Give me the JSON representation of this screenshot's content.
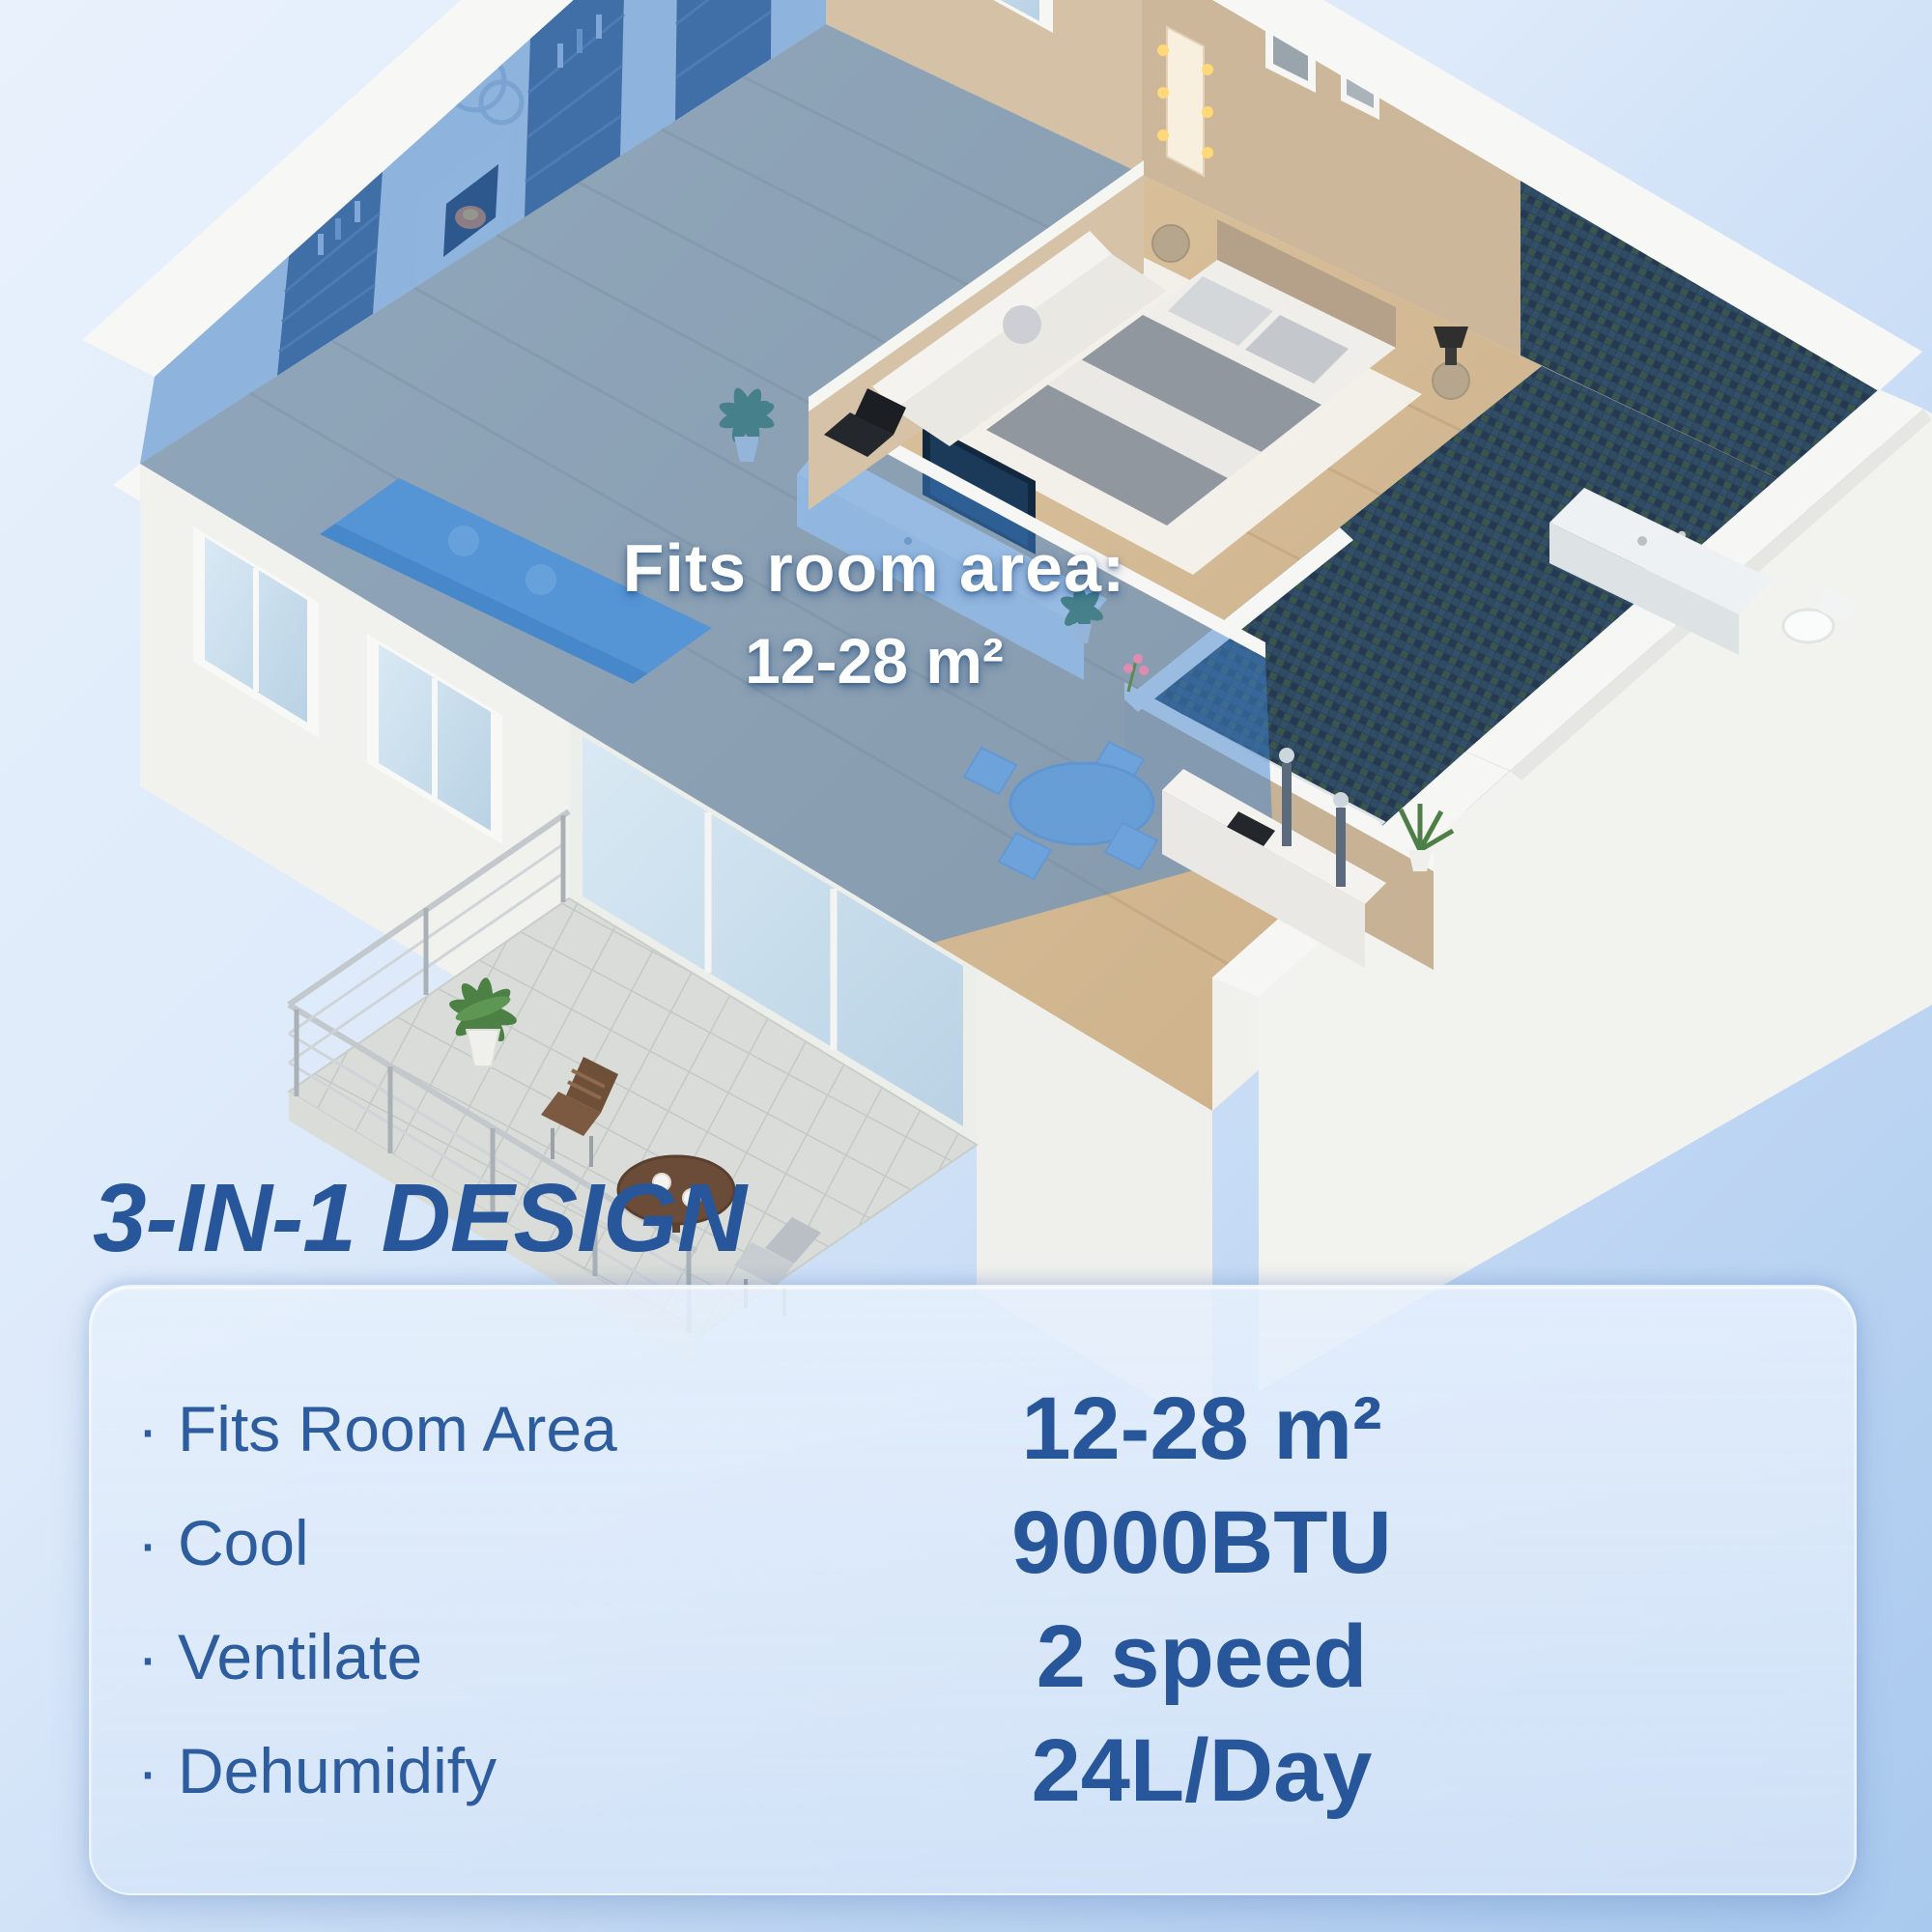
{
  "render": {
    "overlay": {
      "line1": "Fits room area:",
      "line2": "12-28 m²"
    }
  },
  "section": {
    "heading": "3-IN-1 DESIGN"
  },
  "panel": {
    "bullet": "·",
    "features": [
      {
        "label": "Fits Room Area",
        "value": "12-28 m²"
      },
      {
        "label": "Cool",
        "value": "9000BTU"
      },
      {
        "label": "Ventilate",
        "value": "2 speed"
      },
      {
        "label": "Dehumidify",
        "value": "24L/Day"
      }
    ]
  },
  "colors": {
    "accent_text": "#27569b",
    "label_text": "#2e5d9f",
    "highlight_blue": "#3f82cd",
    "background_light": "#e9f1fc",
    "background_dark": "#a9c9ee"
  }
}
